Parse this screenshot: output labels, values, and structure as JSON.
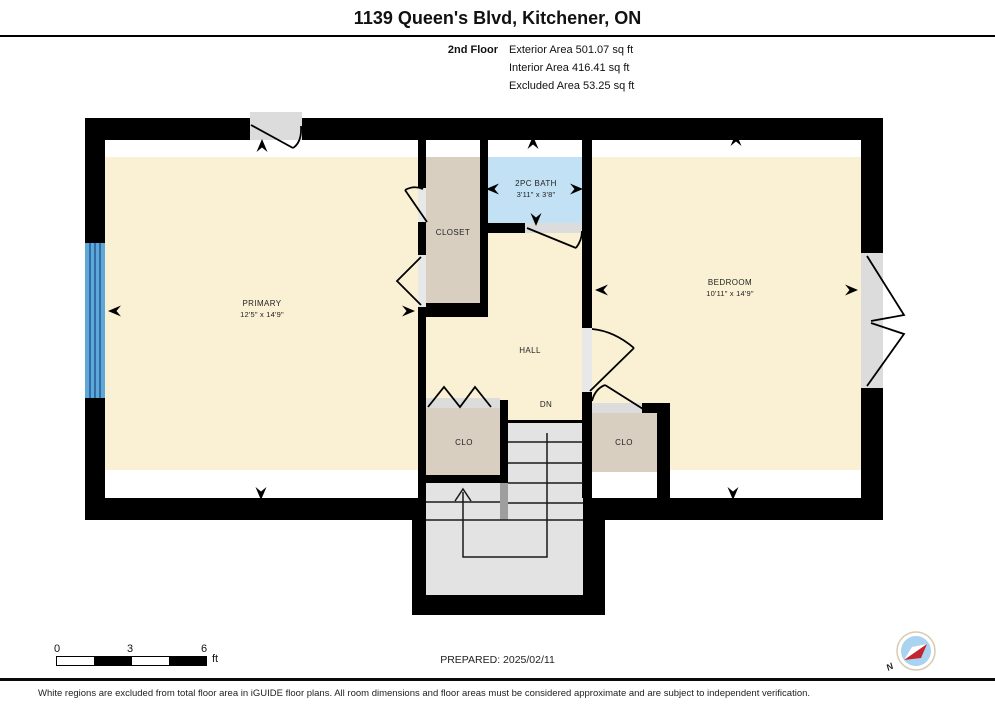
{
  "header": {
    "title": "1139 Queen's Blvd, Kitchener, ON",
    "floor_label": "2nd Floor",
    "stats": [
      "Exterior Area 501.07 sq ft",
      "Interior Area 416.41 sq ft",
      "Excluded Area 53.25 sq ft"
    ]
  },
  "rooms": {
    "primary": {
      "name": "PRIMARY",
      "dims": "12'5\" x 14'9\""
    },
    "bedroom": {
      "name": "BEDROOM",
      "dims": "10'11\" x 14'9\""
    },
    "bath": {
      "name": "2PC BATH",
      "dims": "3'11\" x 3'8\""
    },
    "closet": {
      "name": "CLOSET"
    },
    "hall": {
      "name": "HALL"
    },
    "stairs": {
      "down_label": "DN"
    },
    "closet_left": {
      "name": "CLO"
    },
    "closet_right": {
      "name": "CLO"
    }
  },
  "footer": {
    "scale": {
      "tick0": "0",
      "tick1": "3",
      "tick2": "6",
      "unit": "ft"
    },
    "prepared": "PREPARED: 2025/02/11",
    "compass": {
      "north_label": "N"
    },
    "disclaimer": "White regions are excluded from total floor area in iGUIDE floor plans. All room dimensions and floor areas must be considered approximate and are subject to independent verification."
  },
  "colors": {
    "room_fill": "#FAF1D5",
    "closet_fill": "#D9CFC1",
    "bath_fill": "#C2E1F5",
    "stairs_fill": "#E3E3E3",
    "stairs_divider": "#9E9E9E",
    "threshold_gray": "#DCDCDC",
    "door_gap_gray": "#E8E8E8",
    "window_fill": "#5FA7D8",
    "window_stripe": "#1E5C94",
    "wall": "#000000",
    "compass_red": "#C1272D",
    "compass_blue": "#A9D3EE"
  }
}
